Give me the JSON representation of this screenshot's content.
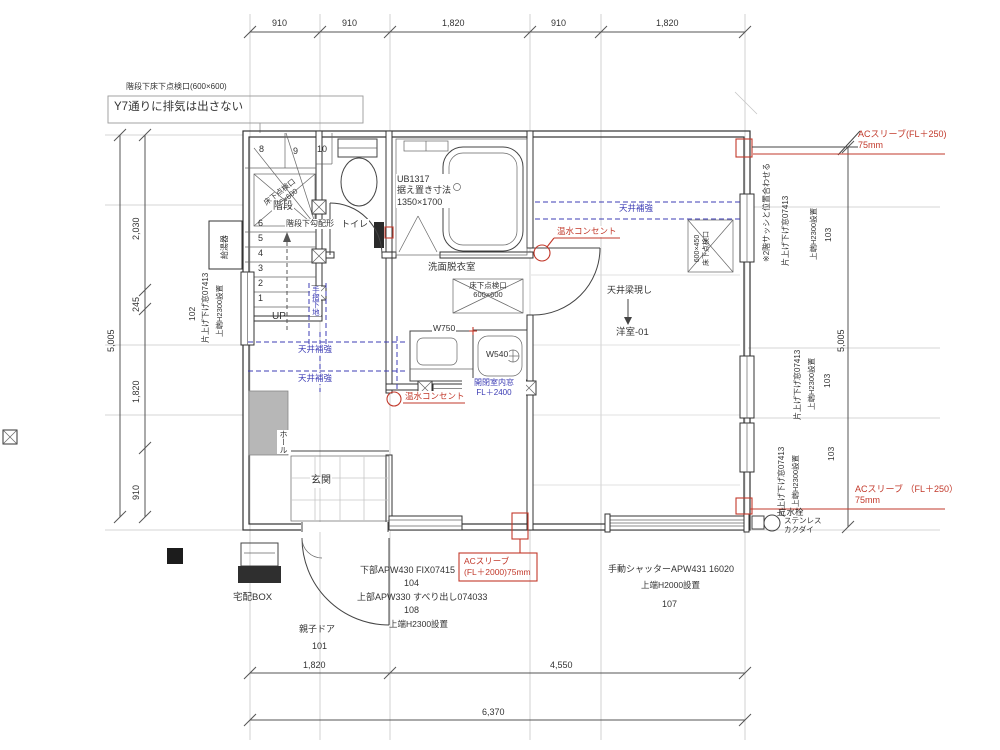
{
  "colors": {
    "red": "#c2392b",
    "blue": "#3c3cb4",
    "line": "#333333",
    "grid": "#c6c6c6"
  },
  "drawing": {
    "type": "floor-plan",
    "room": "洋室-01",
    "total_width_mm": "6,370",
    "total_height_mm": "5,005"
  },
  "labels": [
    {
      "n": "note-stair-hatch",
      "t": "階段下床下点検口(600×600)",
      "x": 126,
      "y": 82,
      "fs": 8
    },
    {
      "n": "note-y7-exhaust",
      "t": "Y7通りに排気は出さない",
      "x": 114,
      "y": 100,
      "fs": 11.5
    },
    {
      "n": "dim-top-910a",
      "t": "910",
      "x": 272,
      "y": 18,
      "fs": 9
    },
    {
      "n": "dim-top-910b",
      "t": "910",
      "x": 342,
      "y": 18,
      "fs": 9
    },
    {
      "n": "dim-top-1820a",
      "t": "1,820",
      "x": 442,
      "y": 18,
      "fs": 9
    },
    {
      "n": "dim-top-910c",
      "t": "910",
      "x": 551,
      "y": 18,
      "fs": 9
    },
    {
      "n": "dim-top-1820b",
      "t": "1,820",
      "x": 656,
      "y": 18,
      "fs": 9
    },
    {
      "n": "stair-step-8",
      "t": "8",
      "x": 259,
      "y": 144,
      "fs": 9
    },
    {
      "n": "stair-step-9",
      "t": "9",
      "x": 293,
      "y": 146,
      "fs": 9
    },
    {
      "n": "stair-step-10",
      "t": "10",
      "x": 317,
      "y": 144,
      "fs": 9
    },
    {
      "n": "stair-step-6",
      "t": "6",
      "x": 258,
      "y": 218,
      "fs": 9
    },
    {
      "n": "stair-step-5",
      "t": "5",
      "x": 258,
      "y": 233,
      "fs": 9
    },
    {
      "n": "stair-step-4",
      "t": "4",
      "x": 258,
      "y": 248,
      "fs": 9
    },
    {
      "n": "stair-step-3",
      "t": "3",
      "x": 258,
      "y": 263,
      "fs": 9
    },
    {
      "n": "stair-step-2",
      "t": "2",
      "x": 258,
      "y": 278,
      "fs": 9
    },
    {
      "n": "stair-step-1",
      "t": "1",
      "x": 258,
      "y": 293,
      "fs": 9
    },
    {
      "n": "stair-hatch",
      "t": "床下点検口\n600×600",
      "x": 262,
      "y": 200,
      "fs": 7.5,
      "c": "pre rot38 ctr"
    },
    {
      "n": "label-stairs",
      "t": "階段",
      "x": 272,
      "y": 201,
      "fs": 10,
      "c": "bg"
    },
    {
      "n": "note-under-stairs",
      "t": "階段下勾配形",
      "x": 285,
      "y": 219,
      "fs": 8,
      "c": "bg"
    },
    {
      "n": "label-toilet",
      "t": "トイレ",
      "x": 340,
      "y": 219,
      "fs": 9,
      "c": "bg"
    },
    {
      "n": "label-bath",
      "t": "UB1317\n据え置き寸法\n1350×1700",
      "x": 396,
      "y": 174,
      "fs": 9,
      "c": "pre bg"
    },
    {
      "n": "label-washroom",
      "t": "洗面脱衣室",
      "x": 428,
      "y": 262,
      "fs": 9.5
    },
    {
      "n": "washroom-hatch",
      "t": "床下点検口\n600×600",
      "x": 455,
      "y": 281,
      "fs": 7.5,
      "c": "pre ctr",
      "w": 66
    },
    {
      "n": "onsui-label-1",
      "t": "温水コンセント",
      "x": 556,
      "y": 226,
      "fs": 8.5,
      "c": "red bg"
    },
    {
      "n": "ceiling-reinforce-1",
      "t": "天井補強",
      "x": 618,
      "y": 203,
      "fs": 8.5,
      "c": "blue bg"
    },
    {
      "n": "room-hatch",
      "t": "600×450\n床下点検口",
      "x": 694,
      "y": 266,
      "fs": 7,
      "c": "pre rotl ctr"
    },
    {
      "n": "label-beam",
      "t": "天井梁現し",
      "x": 607,
      "y": 285,
      "fs": 9
    },
    {
      "n": "label-room01",
      "t": "洋室-01",
      "x": 616,
      "y": 327,
      "fs": 9.5
    },
    {
      "n": "label-w750",
      "t": "W750",
      "x": 432,
      "y": 323,
      "fs": 8.5,
      "c": "bg"
    },
    {
      "n": "label-w540",
      "t": "W540",
      "x": 485,
      "y": 349,
      "fs": 8.5,
      "c": "bg"
    },
    {
      "n": "interior-window",
      "t": "開閉室内窓\nFL＋2400",
      "x": 462,
      "y": 378,
      "fs": 8,
      "c": "pre ctr blue bg",
      "w": 62
    },
    {
      "n": "onsui-label-2",
      "t": "温水コンセント",
      "x": 404,
      "y": 391,
      "fs": 8.5,
      "c": "red bg"
    },
    {
      "n": "ceiling-reinforce-2",
      "t": "天井補強",
      "x": 297,
      "y": 344,
      "fs": 8.5,
      "c": "blue bg"
    },
    {
      "n": "ceiling-reinforce-3",
      "t": "天井補強",
      "x": 297,
      "y": 373,
      "fs": 8.5,
      "c": "blue bg"
    },
    {
      "n": "handrail-base",
      "t": "手摺下地",
      "x": 310,
      "y": 286,
      "fs": 7.5,
      "c": "v blue bg"
    },
    {
      "n": "label-hall",
      "t": "ホール",
      "x": 277,
      "y": 430,
      "fs": 8,
      "c": "v bg"
    },
    {
      "n": "label-genkan",
      "t": "玄関",
      "x": 310,
      "y": 475,
      "fs": 10,
      "c": "bg"
    },
    {
      "n": "label-delivery-box",
      "t": "宅配BOX",
      "x": 233,
      "y": 592,
      "fs": 9.5
    },
    {
      "n": "label-entry-door",
      "t": "親子ドア",
      "x": 299,
      "y": 624,
      "fs": 9
    },
    {
      "n": "num-101",
      "t": "101",
      "x": 312,
      "y": 641,
      "fs": 9
    },
    {
      "n": "label-lower-window",
      "t": "下部APW430  FIX07415",
      "x": 360,
      "y": 565,
      "fs": 9
    },
    {
      "n": "num-104",
      "t": "104",
      "x": 404,
      "y": 578,
      "fs": 9
    },
    {
      "n": "label-upper-window",
      "t": "上部APW330 すべり出し074033",
      "x": 357,
      "y": 592,
      "fs": 9
    },
    {
      "n": "num-108",
      "t": "108",
      "x": 404,
      "y": 605,
      "fs": 9
    },
    {
      "n": "note-h2300",
      "t": "上端H2300設置",
      "x": 389,
      "y": 619,
      "fs": 8.5
    },
    {
      "n": "ac-sleeve-2000",
      "t": "ACスリーブ\n(FL＋2000)75mm",
      "x": 464,
      "y": 556,
      "fs": 8.5,
      "c": "pre red"
    },
    {
      "n": "label-shutter",
      "t": "手動シャッターAPW431  16020",
      "x": 608,
      "y": 564,
      "fs": 9
    },
    {
      "n": "note-h2000",
      "t": "上端H2000設置",
      "x": 641,
      "y": 580,
      "fs": 8.5
    },
    {
      "n": "num-107",
      "t": "107",
      "x": 662,
      "y": 599,
      "fs": 9
    },
    {
      "n": "dim-bottom-1820",
      "t": "1,820",
      "x": 303,
      "y": 660,
      "fs": 9
    },
    {
      "n": "dim-bottom-4550",
      "t": "4,550",
      "x": 550,
      "y": 660,
      "fs": 9
    },
    {
      "n": "dim-bottom-6370",
      "t": "6,370",
      "x": 482,
      "y": 707,
      "fs": 9
    },
    {
      "n": "ac-sleeve-top",
      "t": "ACスリーブ(FL＋250)\n75mm",
      "x": 858,
      "y": 129,
      "fs": 9,
      "c": "pre red"
    },
    {
      "n": "ac-sleeve-bottom",
      "t": "ACスリーブ （FL＋250）\n75mm",
      "x": 855,
      "y": 484,
      "fs": 9,
      "c": "pre red"
    },
    {
      "n": "label-faucet",
      "t": "立水栓",
      "x": 778,
      "y": 507,
      "fs": 8.5
    },
    {
      "n": "label-stainless",
      "t": "ステンレス\nカクダイ",
      "x": 784,
      "y": 516,
      "fs": 7.5,
      "c": "pre"
    },
    {
      "n": "win-a-note",
      "t": "※2階サッシと位置合わせる",
      "x": 762,
      "y": 262,
      "fs": 8,
      "c": "rotl"
    },
    {
      "n": "win-a-name",
      "t": "片上げ下げ窓07413",
      "x": 781,
      "y": 266,
      "fs": 8,
      "c": "rotl"
    },
    {
      "n": "win-a-height",
      "t": "上端H2300設置",
      "x": 809,
      "y": 260,
      "fs": 7.5,
      "c": "rotl"
    },
    {
      "n": "win-a-num",
      "t": "103",
      "x": 823,
      "y": 242,
      "fs": 8.5,
      "c": "rotl"
    },
    {
      "n": "win-b-name",
      "t": "片上げ下げ窓07413",
      "x": 793,
      "y": 420,
      "fs": 8,
      "c": "rotl"
    },
    {
      "n": "win-b-height",
      "t": "上端H2300設置",
      "x": 807,
      "y": 410,
      "fs": 7.5,
      "c": "rotl"
    },
    {
      "n": "win-b-num",
      "t": "103",
      "x": 822,
      "y": 388,
      "fs": 8.5,
      "c": "rotl"
    },
    {
      "n": "win-c-name",
      "t": "片上げ下げ窓07413",
      "x": 777,
      "y": 517,
      "fs": 8,
      "c": "rotl"
    },
    {
      "n": "win-c-height",
      "t": "上端H2300設置",
      "x": 791,
      "y": 507,
      "fs": 7.5,
      "c": "rotl"
    },
    {
      "n": "win-c-num",
      "t": "103",
      "x": 826,
      "y": 461,
      "fs": 8.5,
      "c": "rotl"
    },
    {
      "n": "dim-right-5005",
      "t": "5,005",
      "x": 836,
      "y": 352,
      "fs": 9,
      "c": "rotl"
    },
    {
      "n": "dim-left-5005",
      "t": "5,005",
      "x": 106,
      "y": 352,
      "fs": 9,
      "c": "rotl"
    },
    {
      "n": "dim-left-2030",
      "t": "2,030",
      "x": 131,
      "y": 240,
      "fs": 9,
      "c": "rotl"
    },
    {
      "n": "dim-left-245",
      "t": "245",
      "x": 131,
      "y": 312,
      "fs": 9,
      "c": "rotl"
    },
    {
      "n": "dim-left-1820",
      "t": "1,820",
      "x": 131,
      "y": 403,
      "fs": 9,
      "c": "rotl"
    },
    {
      "n": "dim-left-910",
      "t": "910",
      "x": 131,
      "y": 500,
      "fs": 9,
      "c": "rotl"
    },
    {
      "n": "win-d-name",
      "t": "片上げ下げ窓07413",
      "x": 201,
      "y": 343,
      "fs": 8,
      "c": "rotl"
    },
    {
      "n": "win-d-height",
      "t": "上端H2300設置",
      "x": 215,
      "y": 337,
      "fs": 7.5,
      "c": "rotl"
    },
    {
      "n": "win-d-num",
      "t": "102",
      "x": 187,
      "y": 321,
      "fs": 8.5,
      "c": "rotl"
    },
    {
      "n": "label-water-heater",
      "t": "給湯器",
      "x": 220,
      "y": 259,
      "fs": 8,
      "c": "rotl"
    },
    {
      "n": "label-up",
      "t": "UP",
      "x": 272,
      "y": 311,
      "fs": 10
    }
  ]
}
